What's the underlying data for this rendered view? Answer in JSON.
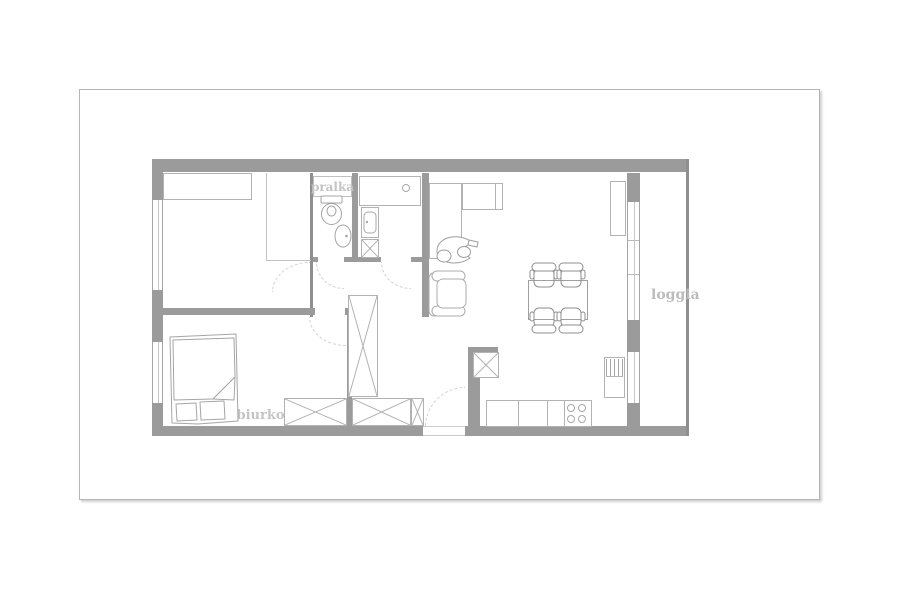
{
  "plan_labels": {
    "washing_machine": "pralka",
    "desk": "biurko",
    "balcony": "loggia"
  },
  "palette": {
    "background": "#ffffff",
    "page_border": "#b5b5b5",
    "wall_fill": "#9b9b9b",
    "thin_wall_fill": "#8f8f8f",
    "furniture_outline": "#b2b2b2",
    "sketch_outline": "#a3a3a3",
    "dining_set_outline": "#8f8f8f",
    "door_swing_dashed": "#d2d2d2",
    "label_text": "#c4c4c4"
  }
}
